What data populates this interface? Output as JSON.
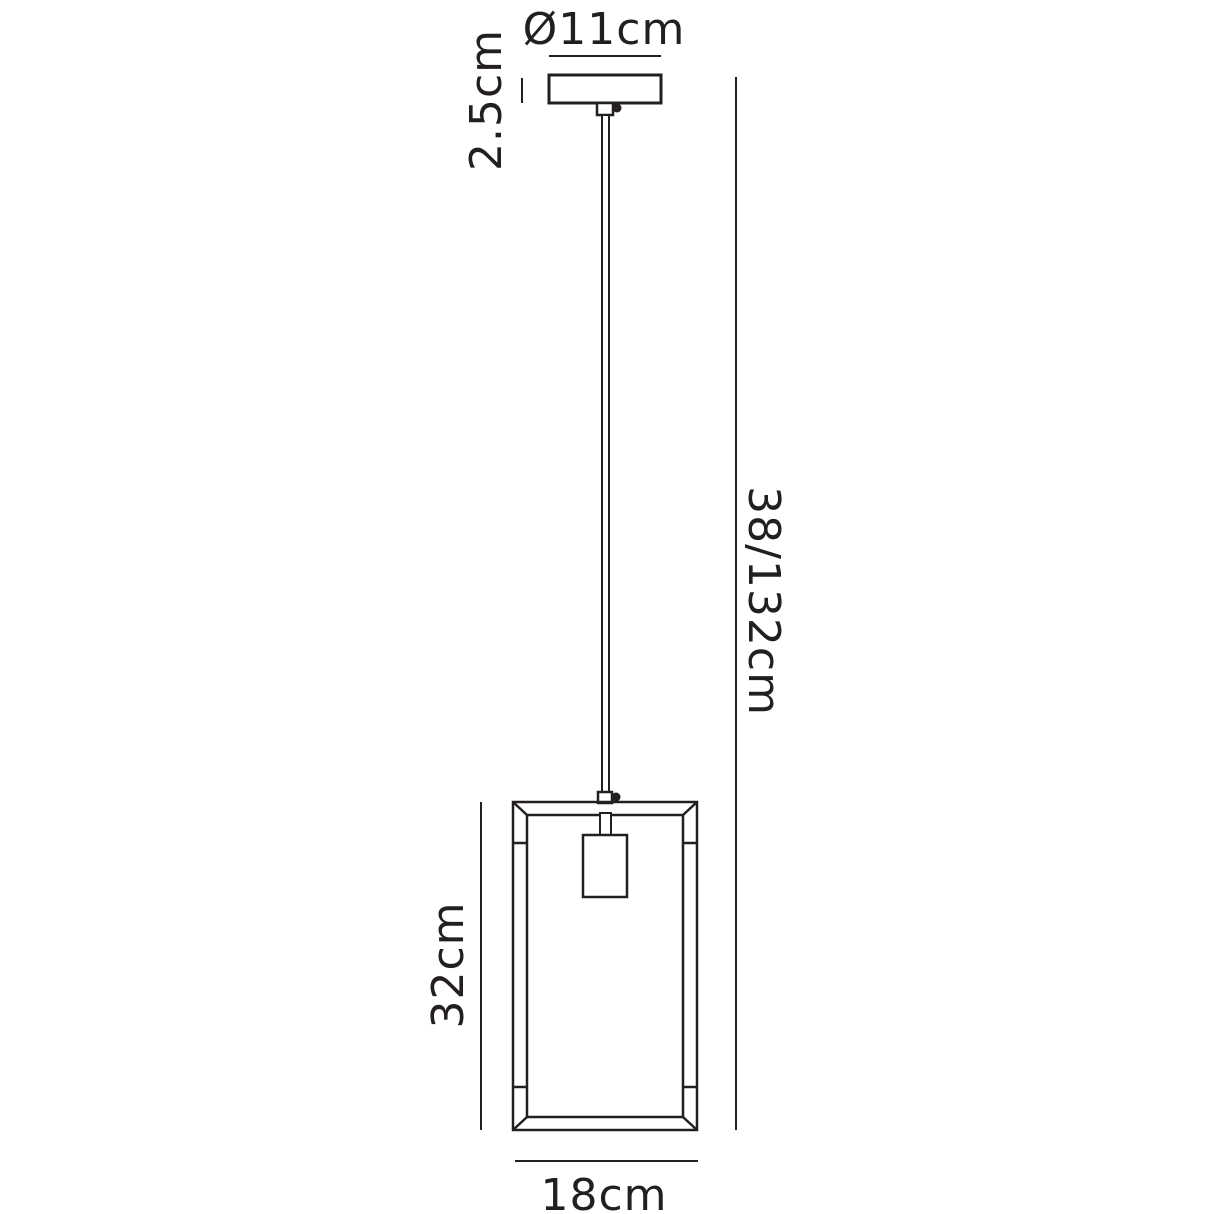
{
  "colors": {
    "line": "#231f20",
    "background": "#ffffff"
  },
  "diagram": {
    "type": "pendant-light-dimension-drawing",
    "labels": {
      "canopy_diameter": "Ø11cm",
      "canopy_height": "2.5cm",
      "overall_drop": "38/132cm",
      "shade_height": "32cm",
      "shade_width": "18cm"
    },
    "dimensions": [
      {
        "name": "canopy-diameter",
        "value": "Ø11cm"
      },
      {
        "name": "canopy-height",
        "value": "2.5cm"
      },
      {
        "name": "overall-drop-height",
        "value": "38/132cm"
      },
      {
        "name": "shade-height",
        "value": "32cm"
      },
      {
        "name": "shade-width",
        "value": "18cm"
      }
    ]
  }
}
